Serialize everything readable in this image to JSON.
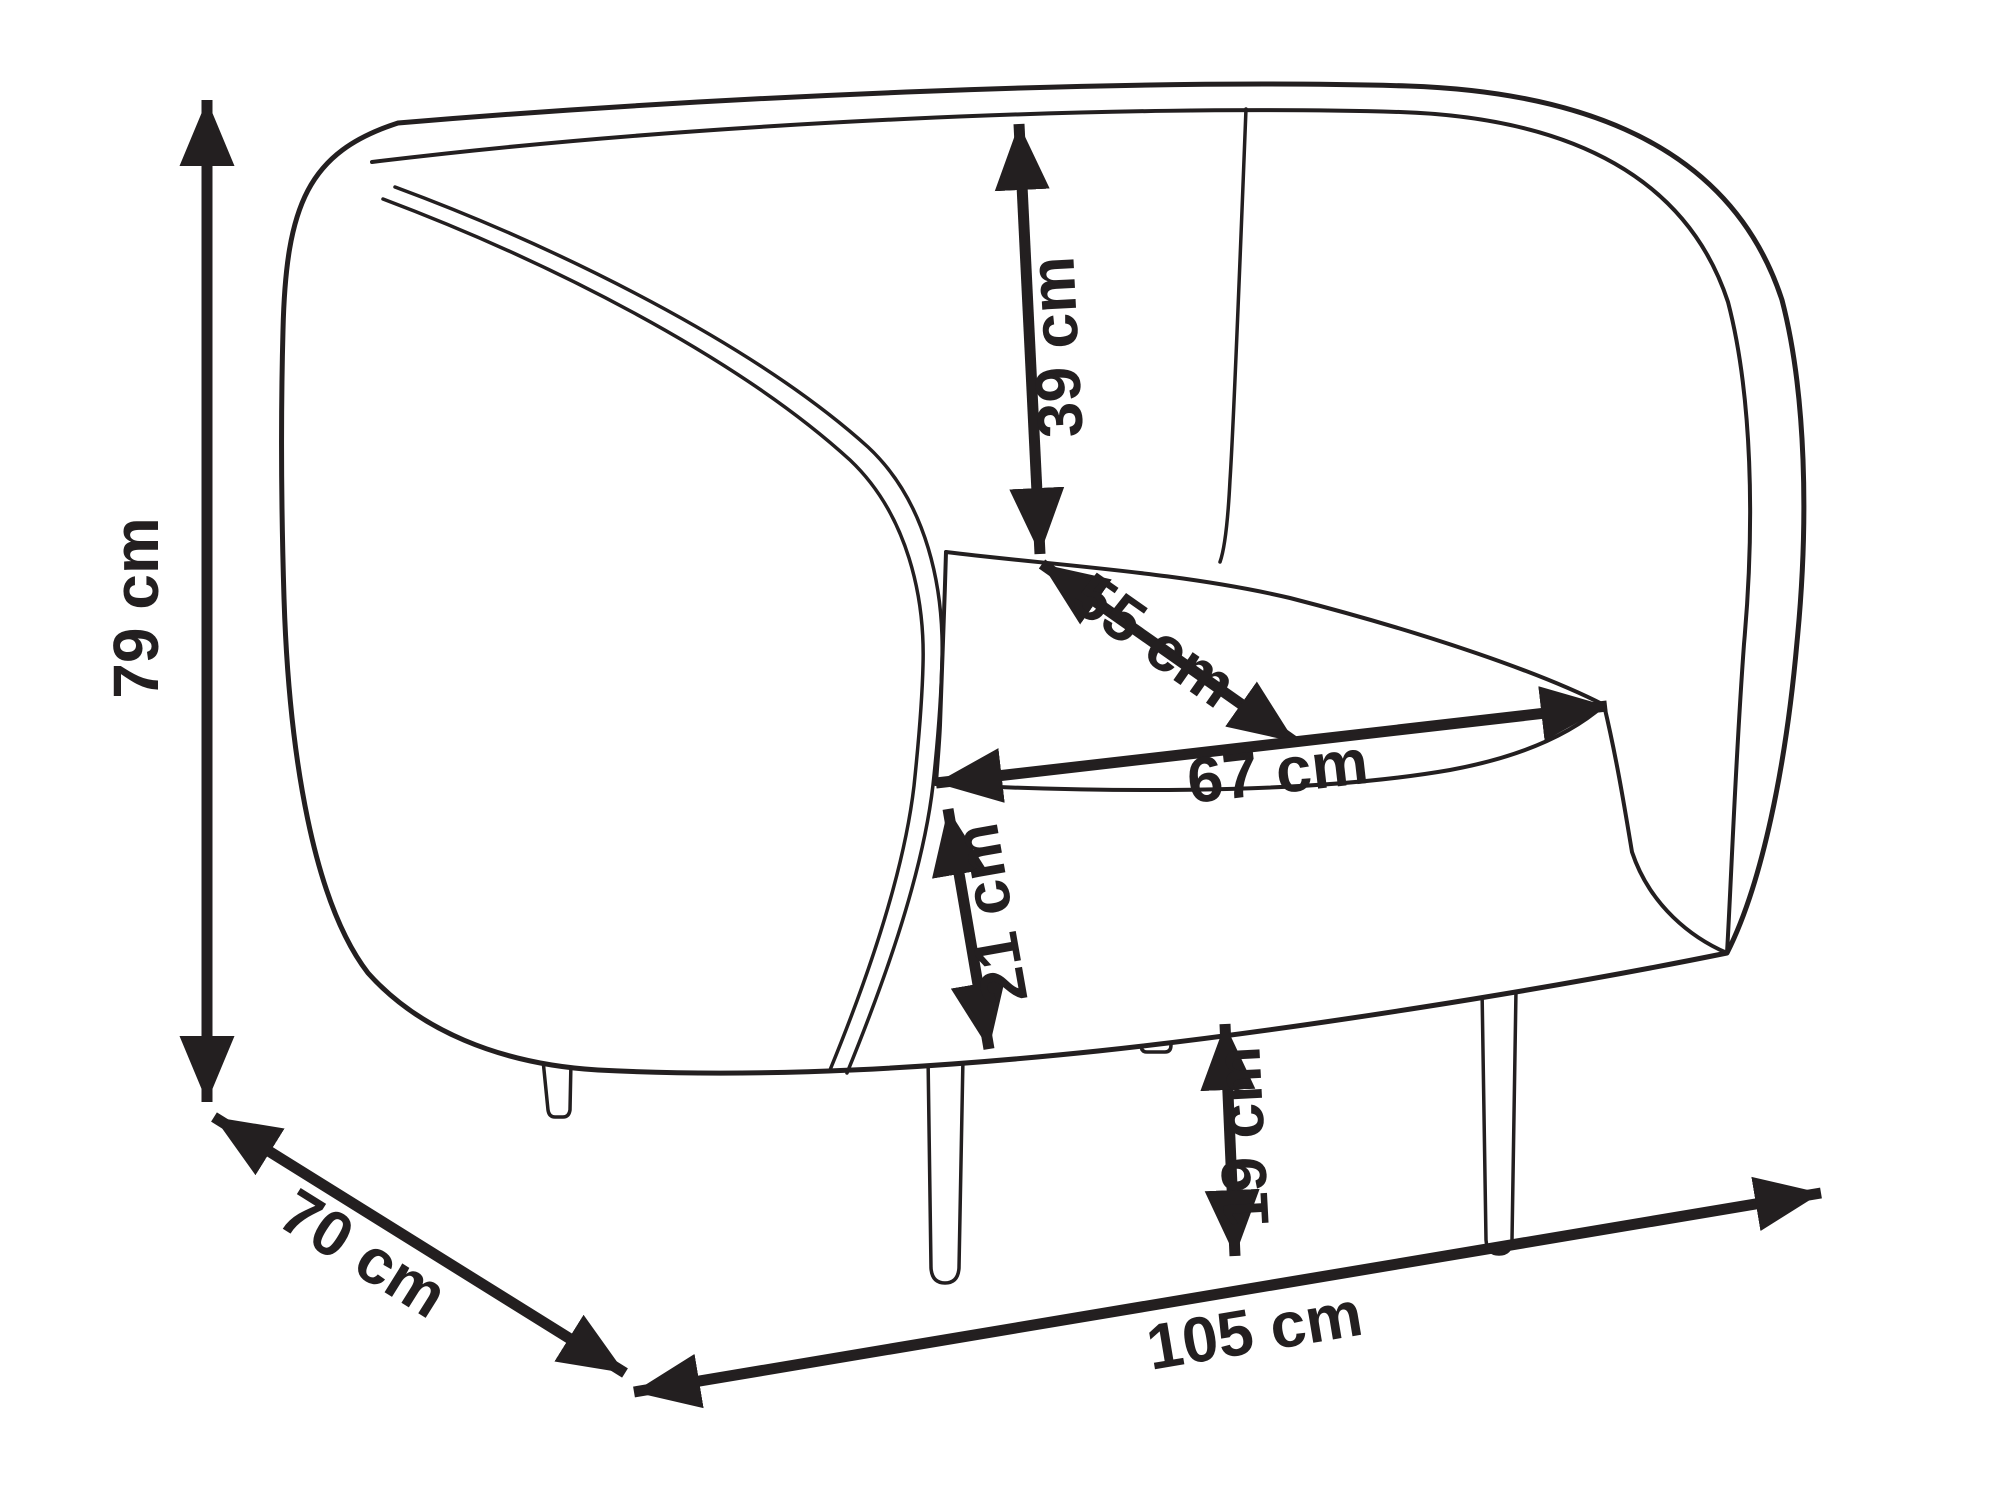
{
  "diagram": {
    "subject": "armchair-technical-dimension-drawing",
    "unit": "cm",
    "dimensions": [
      {
        "id": "overall-height",
        "label": "79 cm",
        "value": 79
      },
      {
        "id": "overall-depth",
        "label": "70 cm",
        "value": 70
      },
      {
        "id": "overall-width",
        "label": "105 cm",
        "value": 105
      },
      {
        "id": "backrest-height",
        "label": "39 cm",
        "value": 39
      },
      {
        "id": "seat-depth",
        "label": "55 cm",
        "value": 55
      },
      {
        "id": "seat-width",
        "label": "67 cm",
        "value": 67
      },
      {
        "id": "seat-front-height",
        "label": "21 cm",
        "value": 21
      },
      {
        "id": "leg-height",
        "label": "19 cm",
        "value": 19
      }
    ],
    "colors": {
      "ink": "#231f20",
      "background": "#ffffff"
    }
  }
}
